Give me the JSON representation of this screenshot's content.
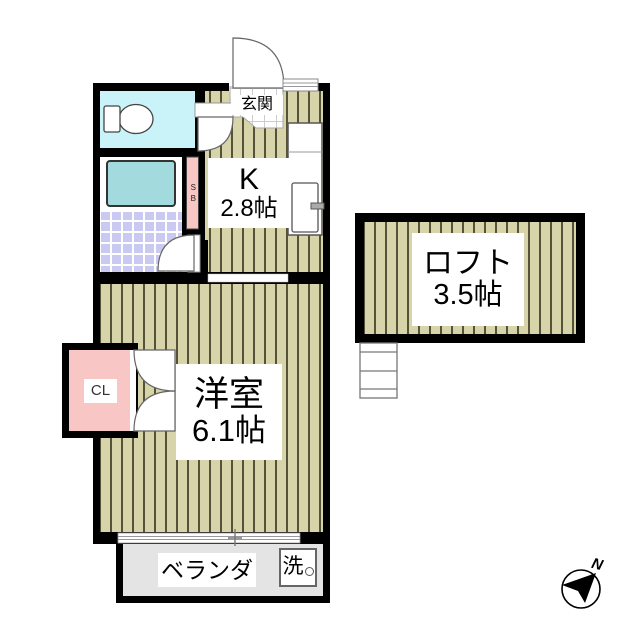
{
  "floor_plan": {
    "genkan": {
      "label": "玄関"
    },
    "kitchen": {
      "label": "K",
      "size": "2.8帖"
    },
    "shoe_box": {
      "label": "SB"
    },
    "loft": {
      "label": "ロフト",
      "size": "3.5帖"
    },
    "western_room": {
      "label": "洋室",
      "size": "6.1帖"
    },
    "closet": {
      "label": "CL"
    },
    "veranda": {
      "label": "ベランダ"
    },
    "washing_machine": {
      "label": "洗"
    },
    "compass": {
      "north_label": "N"
    }
  },
  "colors": {
    "wall": "#000000",
    "flooring": "#d8d4a9",
    "flooring_line": "#55523a",
    "toilet_room": "#c9f3f8",
    "bathtub": "#a3dade",
    "bath_tile": "#c9c9f2",
    "pink_storage": "#f9c6c6",
    "veranda_gray": "#e4e4e4"
  }
}
